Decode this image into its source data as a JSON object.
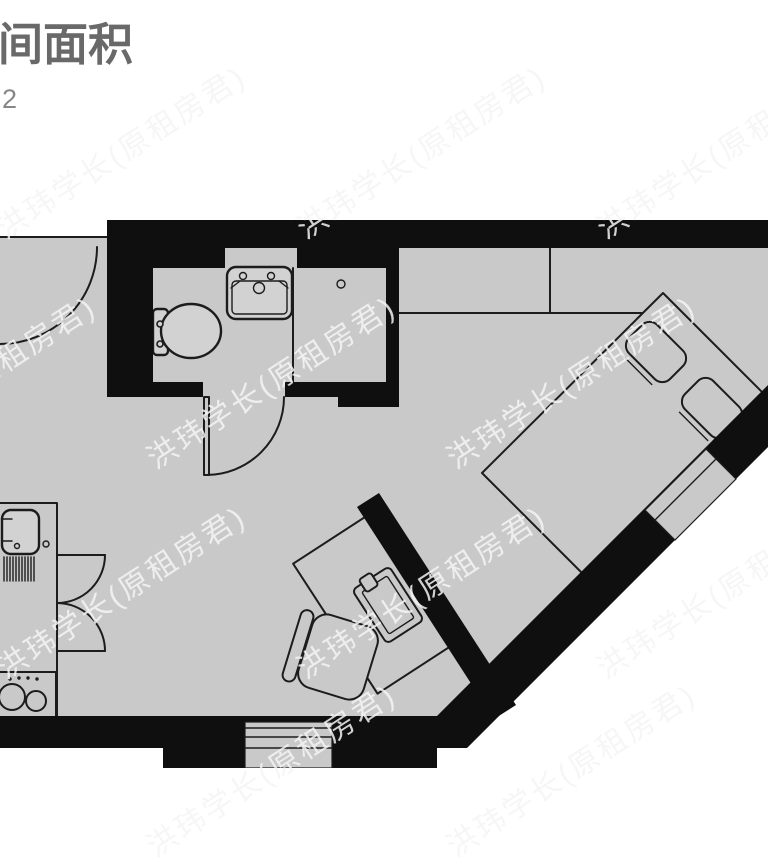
{
  "header": {
    "title": "间面积",
    "area_value": "2"
  },
  "watermark": {
    "text": "洪玮学长(原租房君)"
  },
  "colors": {
    "floor": "#c9c9c9",
    "wall": "#0f0f0f",
    "line": "#1c1c1c",
    "fixture": "#d2d2d2",
    "title_text": "#696969",
    "area_text": "#878787"
  },
  "floorplan": {
    "type": "studio-apartment-floor-plan",
    "rooms_depicted": [
      "entry",
      "bathroom",
      "shower",
      "main-room",
      "kitchenette",
      "sleeping-area"
    ],
    "fixtures_depicted": [
      "toilet",
      "bathroom-sink",
      "floor-drain",
      "wardrobe",
      "bed",
      "pillows",
      "desk",
      "laptop",
      "chair",
      "kitchen-counter",
      "kitchen-sink",
      "drainboard",
      "stove",
      "cabinet-doors",
      "entry-door",
      "bathroom-door",
      "window-south",
      "window-southeast"
    ]
  }
}
